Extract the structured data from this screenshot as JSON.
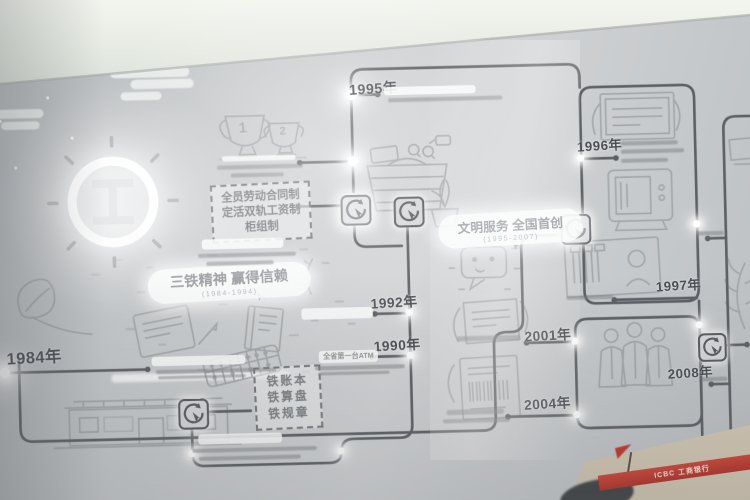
{
  "scene": {
    "description": "Photograph of an ICBC bank history timeline exhibition wall",
    "wall_color": "#c7cacc",
    "ceiling_color": "#eef2ea",
    "timeline_color": "#5d6064",
    "artwork_color": "#9ea1a4",
    "accent_red": "#c0392b"
  },
  "years": {
    "y1984": "1984年",
    "y1990": "1990年",
    "y1992": "1992年",
    "y1995": "1995年",
    "y1996": "1996年",
    "y1997": "1997年",
    "y2001": "2001年",
    "y2004": "2004年",
    "y2008": "2008年"
  },
  "sections": {
    "santie": {
      "title": "三铁精神 赢得信赖",
      "subtitle": "(1984-1994)"
    },
    "wenming": {
      "title": "文明服务 全国首创",
      "subtitle": "(1995-2007)"
    }
  },
  "callouts": {
    "contract": {
      "line1": "全员劳动合同制",
      "line2": "定活双轨工资制",
      "line3": "柜组制"
    },
    "iron": {
      "line1": "铁账本",
      "line2": "铁算盘",
      "line3": "铁规章"
    }
  },
  "captions": {
    "atm": "全省第一台ATM"
  },
  "trophies": {
    "first": "1",
    "second": "2"
  },
  "banner": {
    "text": "ICBC 工商银行"
  },
  "logo": {
    "name": "ICBC emblem"
  }
}
